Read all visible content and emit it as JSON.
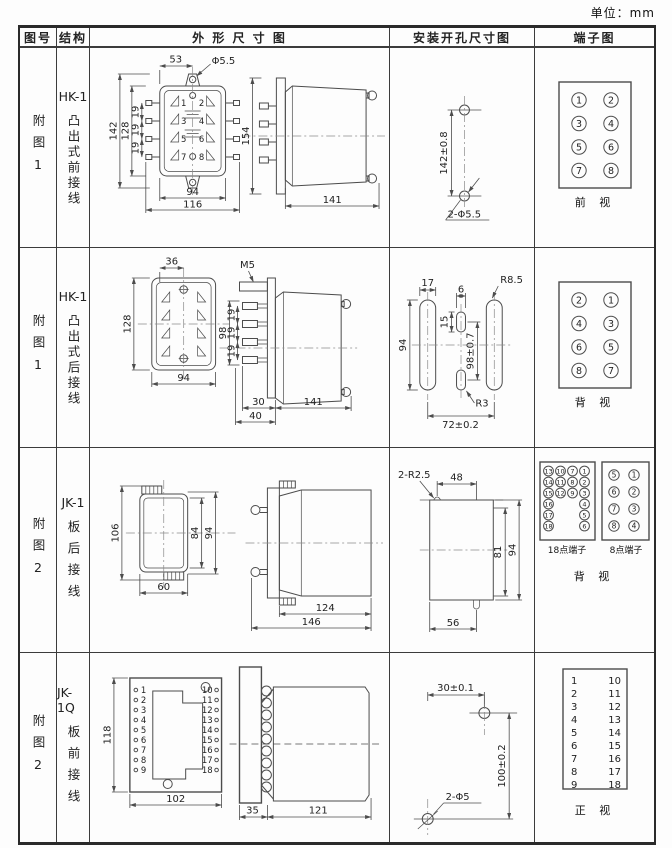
{
  "unit_label": "单位：mm",
  "header": {
    "figure": "图号",
    "structure": "结构",
    "outline": "外 形 尺 寸 图",
    "install": "安装开孔尺寸图",
    "terminal": "端子图"
  },
  "rows": [
    {
      "figure": "附图1",
      "model": "HK-1",
      "structure": "凸出式前接线",
      "outline": {
        "top_width": "53",
        "hole_dia": "Φ5.5",
        "overall_h": "142",
        "body_h": "128",
        "pitch1": "19",
        "pitch2": "19",
        "pitch3": "19",
        "body_w": "94",
        "overall_w": "116",
        "side_h": "154",
        "side_d": "141",
        "pins": [
          "1",
          "2",
          "3",
          "4",
          "5",
          "6",
          "7",
          "8"
        ]
      },
      "install": {
        "v_dim": "142±0.8",
        "holes": "2-Φ5.5"
      },
      "terminal": {
        "left": [
          "1",
          "3",
          "5",
          "7"
        ],
        "right": [
          "2",
          "4",
          "6",
          "8"
        ],
        "view": "前 视"
      }
    },
    {
      "figure": "附图1",
      "model": "HK-1",
      "structure": "凸出式后接线",
      "outline": {
        "top_width": "36",
        "body_h": "128",
        "body_w": "94",
        "thread": "M5",
        "side_h": "98",
        "pitch1": "19",
        "pitch2": "19",
        "pitch3": "19",
        "d1": "30",
        "d2": "40",
        "side_d": "141"
      },
      "install": {
        "slot_w": "17",
        "cslot_w": "6",
        "r_outer": "R8.5",
        "slot_l": "94",
        "cslot_l": "15",
        "v_dim": "98±0.7",
        "r_center": "R3",
        "h_dim": "72±0.2"
      },
      "terminal": {
        "left": [
          "2",
          "4",
          "6",
          "8"
        ],
        "right": [
          "1",
          "3",
          "5",
          "7"
        ],
        "view": "背 视"
      }
    },
    {
      "figure": "附图2",
      "model": "JK-1",
      "structure": "板后接线",
      "outline": {
        "front_h": "106",
        "inner_h": "84",
        "flange_h": "94",
        "front_w": "60",
        "body_d": "124",
        "overall_d": "146"
      },
      "install": {
        "corner_r": "2-R2.5",
        "top_w": "48",
        "inner_h": "81",
        "overall_h": "94",
        "bottom_w": "56"
      },
      "terminal": {
        "grid18": [
          [
            "13",
            "10",
            "7",
            "1"
          ],
          [
            "14",
            "11",
            "8",
            "2"
          ],
          [
            "15",
            "12",
            "9",
            "3"
          ],
          [
            "16",
            "",
            "",
            "4"
          ],
          [
            "17",
            "",
            "",
            "5"
          ],
          [
            "18",
            "",
            "",
            "6"
          ]
        ],
        "label18": "18点端子",
        "left8": [
          "5",
          "6",
          "7",
          "8"
        ],
        "right8": [
          "1",
          "2",
          "3",
          "4"
        ],
        "label8": "8点端子",
        "view": "背 视"
      }
    },
    {
      "figure": "附图2",
      "model": "JK-1Q",
      "structure": "板前接线",
      "outline": {
        "front_h": "118",
        "front_w": "102",
        "left_pins": [
          "1",
          "2",
          "3",
          "4",
          "5",
          "6",
          "7",
          "8",
          "9"
        ],
        "right_pins": [
          "10",
          "11",
          "12",
          "13",
          "14",
          "15",
          "16",
          "17",
          "18"
        ],
        "socket_d": "35",
        "body_d": "121"
      },
      "install": {
        "h_dim": "30±0.1",
        "v_dim": "100±0.2",
        "holes": "2-Φ5"
      },
      "terminal": {
        "left": [
          "1",
          "2",
          "3",
          "4",
          "5",
          "6",
          "7",
          "8",
          "9"
        ],
        "right": [
          "10",
          "11",
          "12",
          "13",
          "14",
          "15",
          "16",
          "17",
          "18"
        ],
        "view": "正 视"
      }
    }
  ]
}
